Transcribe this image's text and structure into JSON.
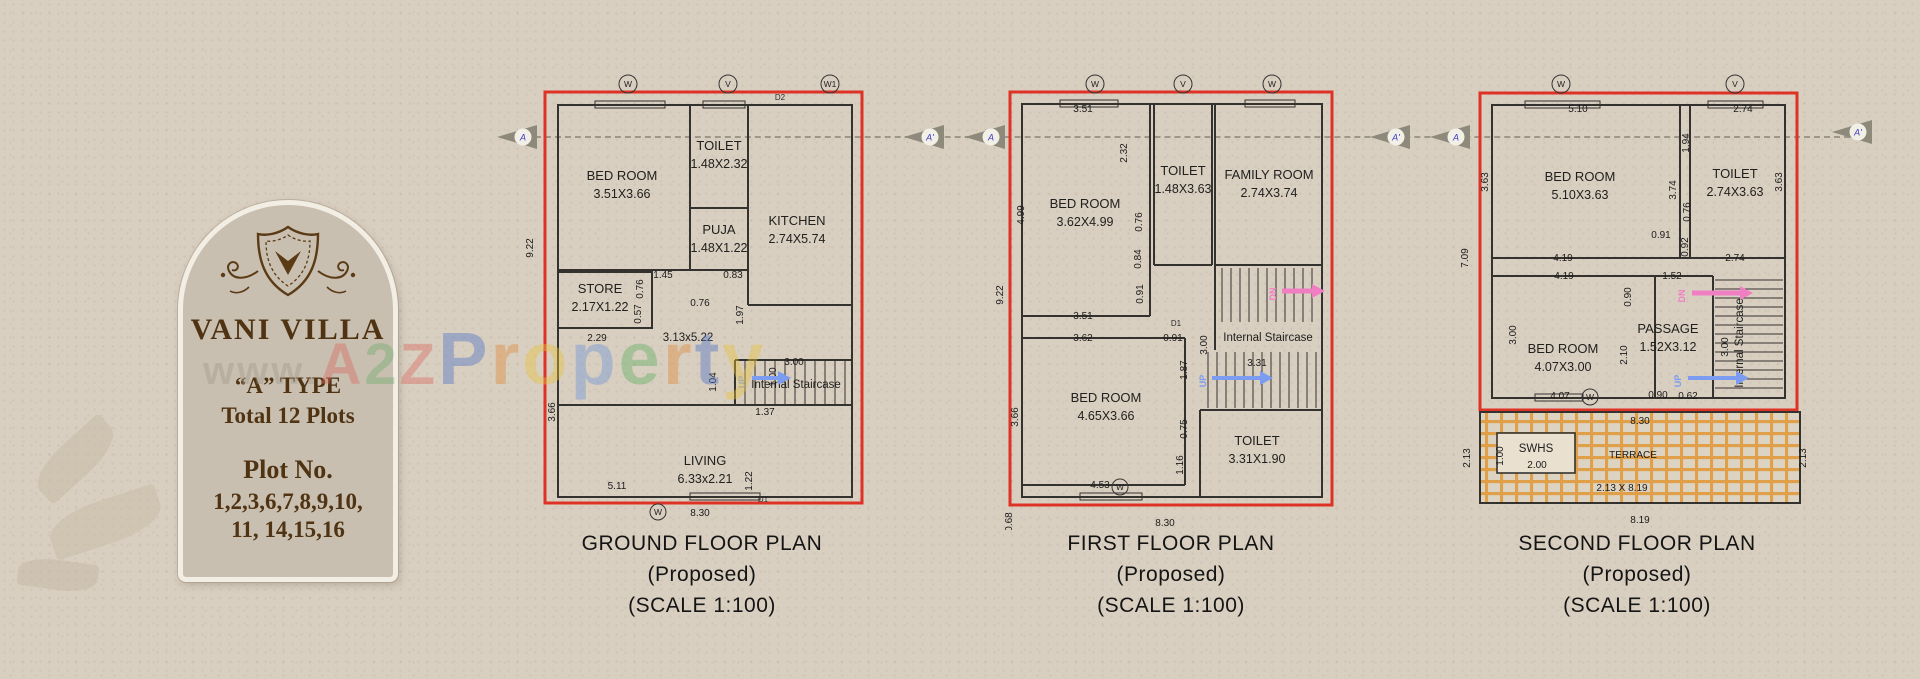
{
  "colors": {
    "red_border": "#de3226",
    "wall": "#34322e",
    "up_arrow": "#7b9cf0",
    "dn_arrow": "#f07ec2",
    "terrace_grid": "#dfa049",
    "card_brown": "#4f3312",
    "marker_letter": "#3b3bc8",
    "paper": "#d9cfc1"
  },
  "card": {
    "title": "VANI VILLA",
    "type_line": "“A” TYPE",
    "total_line": "Total 12 Plots",
    "plot_label": "Plot No.",
    "plot_line1": "1,2,3,6,7,8,9,10,",
    "plot_line2": "11, 14,15,16"
  },
  "watermark": {
    "letters": [
      {
        "ch": "w",
        "color": "#a39b8c",
        "s": 40
      },
      {
        "ch": "w",
        "color": "#a39b8c",
        "s": 40
      },
      {
        "ch": "w",
        "color": "#a39b8c",
        "s": 40
      },
      {
        "ch": ".",
        "color": "#a39b8c",
        "s": 40
      },
      {
        "ch": "A",
        "color": "#d96a62",
        "s": 58
      },
      {
        "ch": "2",
        "color": "#6fae6f",
        "s": 58
      },
      {
        "ch": "Z",
        "color": "#d96a62",
        "s": 58
      },
      {
        "ch": "P",
        "color": "#4f73c8",
        "s": 74
      },
      {
        "ch": "r",
        "color": "#e08a3c",
        "s": 74
      },
      {
        "ch": "o",
        "color": "#e6c23e",
        "s": 74
      },
      {
        "ch": "p",
        "color": "#6f94d8",
        "s": 74
      },
      {
        "ch": "e",
        "color": "#5fae5f",
        "s": 74
      },
      {
        "ch": "r",
        "color": "#e08a3c",
        "s": 74
      },
      {
        "ch": "t",
        "color": "#4f73c8",
        "s": 74
      },
      {
        "ch": "y",
        "color": "#e6c23e",
        "s": 74
      }
    ]
  },
  "section_markers": [
    {
      "label": "A",
      "x": 497,
      "y": 123
    },
    {
      "label": "A'",
      "x": 904,
      "y": 123
    },
    {
      "label": "A",
      "x": 965,
      "y": 123
    },
    {
      "label": "A'",
      "x": 1370,
      "y": 123
    },
    {
      "label": "A",
      "x": 1430,
      "y": 123
    },
    {
      "label": "A'",
      "x": 1832,
      "y": 118
    }
  ],
  "plans": [
    {
      "id": "ground-floor",
      "caption_lines": [
        "GROUND FLOOR PLAN",
        "(Proposed)",
        "(SCALE 1:100)"
      ],
      "caption_left": 552,
      "rooms": [
        {
          "name": "BED ROOM",
          "size": "3.51X3.66",
          "x": 122,
          "y": 120
        },
        {
          "name": "TOILET",
          "size": "1.48X2.32",
          "x": 219,
          "y": 90
        },
        {
          "name": "PUJA",
          "size": "1.48X1.22",
          "x": 219,
          "y": 174
        },
        {
          "name": "KITCHEN",
          "size": "2.74X5.74",
          "x": 297,
          "y": 165
        },
        {
          "name": "STORE",
          "size": "2.17X1.22",
          "x": 100,
          "y": 233
        },
        {
          "name": "LIVING",
          "size": "6.33x2.21",
          "x": 205,
          "y": 405
        }
      ],
      "labels": [
        {
          "t": "3.13x5.22",
          "x": 188,
          "y": 281
        },
        {
          "t": "Internal Staircase",
          "x": 296,
          "y": 328
        }
      ],
      "dims": [
        {
          "v": "9.22",
          "x": 33,
          "y": 188,
          "r": -90
        },
        {
          "v": "3.66",
          "x": 55,
          "y": 352,
          "r": -90
        },
        {
          "v": "2.29",
          "x": 97,
          "y": 281
        },
        {
          "v": "0.76",
          "x": 143,
          "y": 229,
          "r": -90
        },
        {
          "v": "0.57",
          "x": 141,
          "y": 254,
          "r": -90
        },
        {
          "v": "1.45",
          "x": 163,
          "y": 218
        },
        {
          "v": "0.76",
          "x": 200,
          "y": 246
        },
        {
          "v": "0.83",
          "x": 233,
          "y": 218
        },
        {
          "v": "1.97",
          "x": 243,
          "y": 255,
          "r": -90
        },
        {
          "v": "1.04",
          "x": 216,
          "y": 322,
          "r": -90
        },
        {
          "v": "3.00",
          "x": 294,
          "y": 305
        },
        {
          "v": "1.00",
          "x": 276,
          "y": 317,
          "r": -90
        },
        {
          "v": "1.37",
          "x": 265,
          "y": 355
        },
        {
          "v": "5.11",
          "x": 117,
          "y": 429
        },
        {
          "v": "1.22",
          "x": 252,
          "y": 421,
          "r": -90
        },
        {
          "v": "8.30",
          "x": 200,
          "y": 456
        }
      ],
      "doors": [
        {
          "t": "D2",
          "x": 280,
          "y": 40
        },
        {
          "t": "D1",
          "x": 263,
          "y": 442
        }
      ],
      "top_markers": [
        {
          "label": "W",
          "x": 128
        },
        {
          "label": "V",
          "x": 228
        },
        {
          "label": "W1",
          "x": 330
        }
      ],
      "mid_markers": [
        {
          "label": "W",
          "x": 158,
          "y": 452
        }
      ],
      "arrows": [
        {
          "t": "UP",
          "c": "up",
          "x": 252,
          "y": 318,
          "len": 26,
          "tx": 245,
          "ty": 322,
          "tr": -90
        }
      ],
      "stairs": [
        {
          "x": 245,
          "y": 300,
          "w": 100,
          "h": 45,
          "step": 10,
          "dir": "v"
        }
      ]
    },
    {
      "id": "first-floor",
      "caption_lines": [
        "FIRST FLOOR PLAN",
        "(Proposed)",
        "(SCALE 1:100)"
      ],
      "caption_left": 1021,
      "rooms": [
        {
          "name": "BED ROOM",
          "size": "3.62X4.99",
          "x": 125,
          "y": 148
        },
        {
          "name": "TOILET",
          "size": "1.48X3.63",
          "x": 223,
          "y": 115
        },
        {
          "name": "FAMILY ROOM",
          "size": "2.74X3.74",
          "x": 309,
          "y": 119
        },
        {
          "name": "BED ROOM",
          "size": "4.65X3.66",
          "x": 146,
          "y": 342
        },
        {
          "name": "TOILET",
          "size": "3.31X1.90",
          "x": 297,
          "y": 385
        }
      ],
      "labels": [
        {
          "t": "Internal Staircase",
          "x": 308,
          "y": 281
        },
        {
          "t": "CHAJJA",
          "x": 205,
          "y": 477,
          "cls": "door"
        }
      ],
      "dims": [
        {
          "v": "3.51",
          "x": 123,
          "y": 52
        },
        {
          "v": "2.32",
          "x": 167,
          "y": 93,
          "r": -90
        },
        {
          "v": "4.99",
          "x": 64,
          "y": 155,
          "r": -90
        },
        {
          "v": "9.22",
          "x": 43,
          "y": 235,
          "r": -90
        },
        {
          "v": "0.76",
          "x": 182,
          "y": 162,
          "r": -90
        },
        {
          "v": "0.84",
          "x": 181,
          "y": 199,
          "r": -90
        },
        {
          "v": "0.91",
          "x": 183,
          "y": 234,
          "r": -90
        },
        {
          "v": "3.51",
          "x": 123,
          "y": 259
        },
        {
          "v": "3.62",
          "x": 123,
          "y": 281
        },
        {
          "v": "0.91",
          "x": 213,
          "y": 281
        },
        {
          "v": "3.00",
          "x": 247,
          "y": 285,
          "r": -90
        },
        {
          "v": "1.87",
          "x": 227,
          "y": 310,
          "r": -90
        },
        {
          "v": "3.31",
          "x": 297,
          "y": 306
        },
        {
          "v": "3.66",
          "x": 58,
          "y": 357,
          "r": -90
        },
        {
          "v": "0.75",
          "x": 227,
          "y": 369,
          "r": -90
        },
        {
          "v": "1.16",
          "x": 223,
          "y": 405,
          "r": -90
        },
        {
          "v": "4.53",
          "x": 140,
          "y": 428
        },
        {
          "v": "8.30",
          "x": 205,
          "y": 466
        },
        {
          "v": "0.68",
          "x": 52,
          "y": 462,
          "r": -90
        }
      ],
      "doors": [
        {
          "t": "D1",
          "x": 216,
          "y": 266
        }
      ],
      "top_markers": [
        {
          "label": "W",
          "x": 135
        },
        {
          "label": "V",
          "x": 223
        },
        {
          "label": "W",
          "x": 312
        }
      ],
      "mid_markers": [
        {
          "label": "W",
          "x": 160,
          "y": 427
        }
      ],
      "arrows": [
        {
          "t": "DN",
          "c": "dn",
          "x": 322,
          "y": 231,
          "len": 30,
          "tx": 316,
          "ty": 234,
          "tr": -90
        },
        {
          "t": "UP",
          "c": "up",
          "x": 252,
          "y": 318,
          "len": 48,
          "tx": 246,
          "ty": 321,
          "tr": -90
        }
      ],
      "stairs": [
        {
          "x": 262,
          "y": 208,
          "w": 94,
          "h": 54,
          "step": 9,
          "dir": "v"
        },
        {
          "x": 248,
          "y": 292,
          "w": 108,
          "h": 56,
          "step": 9,
          "dir": "v"
        }
      ]
    },
    {
      "id": "second-floor",
      "caption_lines": [
        "SECOND FLOOR PLAN",
        "(Proposed)",
        "(SCALE 1:100)"
      ],
      "caption_left": 1487,
      "rooms": [
        {
          "name": "BED ROOM",
          "size": "5.10X3.63",
          "x": 140,
          "y": 121
        },
        {
          "name": "TOILET",
          "size": "2.74X3.63",
          "x": 295,
          "y": 118
        },
        {
          "name": "BED ROOM",
          "size": "4.07X3.00",
          "x": 123,
          "y": 293
        },
        {
          "name": "PASSAGE",
          "size": "1.52X3.12",
          "x": 228,
          "y": 273
        }
      ],
      "labels": [
        {
          "t": "Internal Staircase",
          "x": 303,
          "y": 283,
          "r": -90
        },
        {
          "t": "TERRACE",
          "x": 193,
          "y": 398,
          "cls": "dim"
        },
        {
          "t": "SWHS",
          "x": 96,
          "y": 392
        }
      ],
      "dims": [
        {
          "v": "5.10",
          "x": 138,
          "y": 52
        },
        {
          "v": "2.74",
          "x": 303,
          "y": 52
        },
        {
          "v": "3.63",
          "x": 48,
          "y": 122,
          "r": -90
        },
        {
          "v": "1.94",
          "x": 249,
          "y": 83,
          "r": -90
        },
        {
          "v": "3.74",
          "x": 236,
          "y": 130,
          "r": -90
        },
        {
          "v": "0.76",
          "x": 250,
          "y": 152,
          "r": -90
        },
        {
          "v": "3.63",
          "x": 342,
          "y": 122,
          "r": -90
        },
        {
          "v": "0.91",
          "x": 221,
          "y": 178
        },
        {
          "v": "0.92",
          "x": 248,
          "y": 187,
          "r": -90
        },
        {
          "v": "7.09",
          "x": 28,
          "y": 198,
          "r": -90
        },
        {
          "v": "4.19",
          "x": 123,
          "y": 201
        },
        {
          "v": "4.19",
          "x": 124,
          "y": 219
        },
        {
          "v": "2.74",
          "x": 295,
          "y": 201
        },
        {
          "v": "1.52",
          "x": 232,
          "y": 219
        },
        {
          "v": "0.90",
          "x": 191,
          "y": 237,
          "r": -90
        },
        {
          "v": "3.00",
          "x": 76,
          "y": 275,
          "r": -90
        },
        {
          "v": "2.10",
          "x": 187,
          "y": 295,
          "r": -90
        },
        {
          "v": "3.00",
          "x": 288,
          "y": 287,
          "r": -90
        },
        {
          "v": "4.07",
          "x": 120,
          "y": 339
        },
        {
          "v": "0.90",
          "x": 218,
          "y": 338
        },
        {
          "v": "0.62",
          "x": 248,
          "y": 339
        },
        {
          "v": "8.30",
          "x": 200,
          "y": 364
        },
        {
          "v": "1.00",
          "x": 63,
          "y": 396,
          "r": -90
        },
        {
          "v": "2.00",
          "x": 97,
          "y": 408
        },
        {
          "v": "2.13 X 8.19",
          "x": 182,
          "y": 431
        },
        {
          "v": "2.13",
          "x": 366,
          "y": 398,
          "r": -90
        },
        {
          "v": "2.13",
          "x": 30,
          "y": 398,
          "r": -90
        },
        {
          "v": "8.19",
          "x": 200,
          "y": 463
        }
      ],
      "doors": [],
      "top_markers": [
        {
          "label": "W",
          "x": 121
        },
        {
          "label": "V",
          "x": 295
        }
      ],
      "mid_markers": [
        {
          "label": "W",
          "x": 150,
          "y": 337
        }
      ],
      "arrows": [
        {
          "t": "DN",
          "c": "dn",
          "x": 252,
          "y": 233,
          "len": 48,
          "tx": 245,
          "ty": 236,
          "tr": -90
        },
        {
          "t": "UP",
          "c": "up",
          "x": 248,
          "y": 318,
          "len": 48,
          "tx": 241,
          "ty": 321,
          "tr": -90
        }
      ],
      "stairs": [
        {
          "x": 275,
          "y": 220,
          "w": 68,
          "h": 112,
          "step": 9,
          "dir": "h"
        }
      ]
    }
  ]
}
